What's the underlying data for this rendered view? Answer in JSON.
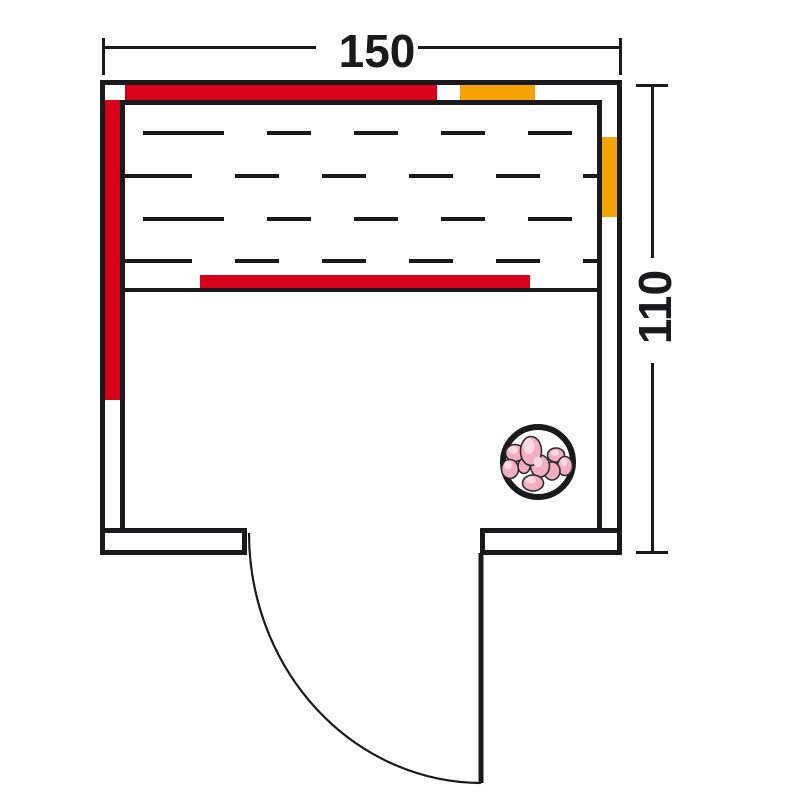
{
  "diagram": {
    "title": "sauna-floor-plan",
    "dimensions": {
      "width": "150",
      "depth": "110"
    },
    "colors": {
      "background": "#ffffff",
      "line": "#1a1a1d",
      "red": "#d6001a",
      "orange": "#f5a302",
      "stone_fill": "#f3aec2",
      "stone_highlight": "#fbd9e2",
      "stone_outline": "#2b2b30"
    },
    "legend_semantics": {
      "red_strip": "infrared-emitter-panel",
      "orange_strip": "heater-element",
      "dashed_area": "bench-slats",
      "circle_with_stones": "sauna-heater-stones",
      "arc": "door-swing"
    }
  }
}
